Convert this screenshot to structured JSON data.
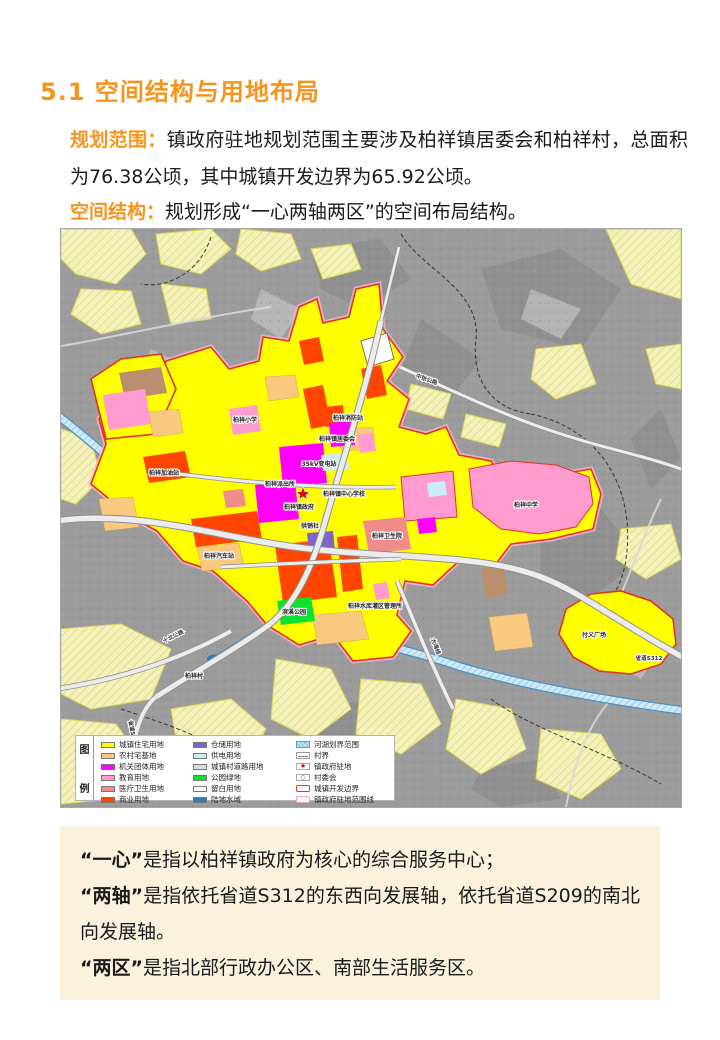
{
  "page": {
    "title": "5.1 空间结构与用地布局",
    "para1_label": "规划范围：",
    "para1_text": "镇政府驻地规划范围主要涉及柏祥镇居委会和柏祥村，总面积为76.38公顷，其中城镇开发边界为65.92公顷。",
    "para2_label": "空间结构：",
    "para2_text": "规划形成“一心两轴两区”的空间布局结构。"
  },
  "colors": {
    "accent_orange": "#F7941D",
    "summary_box_bg": "#FBF1DC",
    "map_base_gray": "#9c9c9c",
    "development_boundary_red": "#E63222",
    "gov_scope_pink": "#F8B6D2"
  },
  "map": {
    "labels": {
      "road_zhongzhang": "中张公路",
      "road_s312": "省道S312",
      "road_s209": "省道S209",
      "road_shibei": "十北公路",
      "road_dawan": "大湾线",
      "primary_school": "柏祥小学",
      "fire_station": "柏祥消防站",
      "residents_committee": "柏祥镇居委会",
      "substation": "35kV变电站",
      "police_station": "柏祥派出所",
      "central_school": "柏祥镇中心学校",
      "town_government": "柏祥镇政府",
      "supply_coop": "供销社",
      "middle_school": "柏祥中学",
      "health_center": "柏祥卫生院",
      "gas_station": "柏祥加油站",
      "bus_station": "柏祥汽车站",
      "reservoir_office": "柏祥水库灌区管理所",
      "riverside_park": "滨溪公园",
      "fuyi_square": "付义广场",
      "baixiang_village": "柏祥村"
    },
    "legend": {
      "title_top": "图",
      "title_bottom": "例",
      "col1": [
        {
          "label": "城镇住宅用地",
          "color": "#FFFF00"
        },
        {
          "label": "农村宅基地",
          "color": "#F9C97E"
        },
        {
          "label": "机关团体用地",
          "color": "#FF00FF"
        },
        {
          "label": "教育用地",
          "color": "#FF9BCE"
        },
        {
          "label": "医疗卫生用地",
          "color": "#F08C8C"
        },
        {
          "label": "商业用地",
          "color": "#FF4500"
        },
        {
          "label": "工业用地",
          "color": "#BA8E6E"
        }
      ],
      "col2": [
        {
          "label": "仓储用地",
          "color": "#7D64C8"
        },
        {
          "label": "供电用地",
          "color": "#CBEDFA"
        },
        {
          "label": "城镇村道路用地",
          "color": "#DEDEDE"
        },
        {
          "label": "公园绿地",
          "color": "#0AE42E"
        },
        {
          "label": "留白用地",
          "color": "#FFFFFF"
        },
        {
          "label": "陆地水域",
          "color": "#2E7EB8"
        },
        {
          "label": "永久基本农田",
          "color": "#F5F2BE"
        }
      ],
      "col3": [
        {
          "label": "河湖划界范围"
        },
        {
          "label": "村界"
        },
        {
          "label": "镇政府驻地"
        },
        {
          "label": "村委会"
        },
        {
          "label": "城镇开发边界"
        },
        {
          "label": "镇政府驻地范围线"
        }
      ],
      "star_glyph": "★",
      "committee_glyph": "○"
    }
  },
  "summary": {
    "items": [
      {
        "term": "“一心”",
        "text": "是指以柏祥镇政府为核心的综合服务中心；"
      },
      {
        "term": "“两轴”",
        "text": "是指依托省道S312的东西向发展轴，依托省道S209的南北向发展轴。"
      },
      {
        "term": "“两区”",
        "text": "是指北部行政办公区、南部生活服务区。"
      }
    ]
  }
}
